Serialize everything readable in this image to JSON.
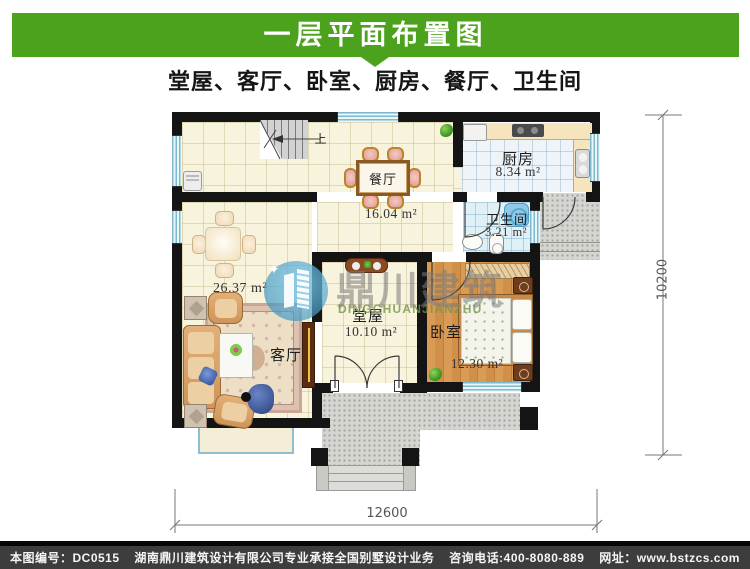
{
  "header": {
    "title": "一层平面布置图",
    "subtitle": "堂屋、客厅、卧室、厨房、餐厅、卫生间"
  },
  "theme": {
    "banner_green": "#4CA21D",
    "footer_bg": "#3D3D3D",
    "wall_black": "#141414",
    "window_blue": "#7DB8CC"
  },
  "plan": {
    "rooms": [
      {
        "name": "餐厅",
        "area": "16.04 m²"
      },
      {
        "name": "厨房",
        "area": "8.34 m²"
      },
      {
        "name": "卫生间",
        "area": "3.21 m²"
      },
      {
        "name": "客厅",
        "area": "26.37 m²"
      },
      {
        "name": "堂屋",
        "area": "10.10 m²"
      },
      {
        "name": "卧室",
        "area": "12.30 m²"
      }
    ],
    "stairs_up_label": "上",
    "dimensions": {
      "width_mm": "12600",
      "height_mm": "10200"
    }
  },
  "watermark": {
    "cn": "鼎川建筑",
    "en": "DINGCHUANJIANZHU"
  },
  "footer": {
    "drawing_no": "本图编号：DC0515",
    "company": "湖南鼎川建筑设计有限公司专业承接全国别墅设计业务",
    "phone": "咨询电话:400-8080-889",
    "website": "网址：www.bstzcs.com"
  }
}
